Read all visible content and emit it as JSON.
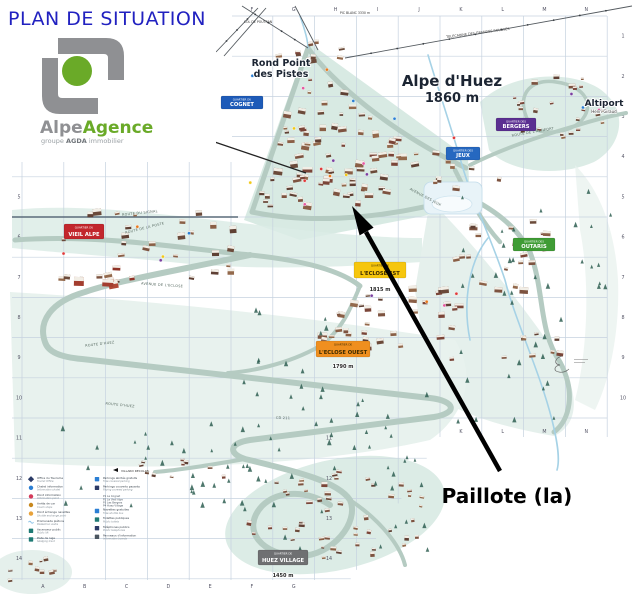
{
  "title": "PLAN DE SITUATION",
  "title_color": "#2121c0",
  "logo": {
    "brand_alpe": "Alpe",
    "brand_agence": "Agence",
    "tagline_prefix": "groupe",
    "tagline_brand": "AGDA",
    "tagline_suffix": "immobilier",
    "gray": "#8f9093",
    "green": "#6aaa28"
  },
  "callout": {
    "label": "Paillote (la)"
  },
  "map": {
    "resort": {
      "name": "Alpe d'Huez",
      "altitude": "1860 m"
    },
    "places": {
      "rond_point_line1": "Rond Point",
      "rond_point_line2": "des Pistes",
      "altiport": "Altiport",
      "altiport_sub": "Henri Giraud",
      "pic_blanc": "PIC BLANC 3330 m",
      "col_de_poutran": "COL DE POUTRAN",
      "telecabine": "TELECABINE DES GRANDES ROUSSES",
      "villard_reculas": "VILLARD RECULAS"
    },
    "quarters": [
      {
        "id": "cognet",
        "prefix": "QUARTIER DU",
        "name": "COGNET",
        "bg": "#1e5bb8",
        "fg": "#ffffff"
      },
      {
        "id": "bergers",
        "prefix": "QUARTIER DES",
        "name": "BERGERS",
        "bg": "#5b2f91",
        "fg": "#ffffff"
      },
      {
        "id": "jeux",
        "prefix": "QUARTIER DES",
        "name": "JEUX",
        "bg": "#2668c0",
        "fg": "#ffffff"
      },
      {
        "id": "vieil_alpe",
        "prefix": "QUARTIER DU",
        "name": "VIEIL ALPE",
        "bg": "#c2262c",
        "fg": "#ffffff"
      },
      {
        "id": "outaris",
        "prefix": "QUARTIER DES",
        "name": "OUTARIS",
        "bg": "#3f9c35",
        "fg": "#ffffff"
      },
      {
        "id": "eclose_est",
        "prefix": "QUARTIER DE",
        "name": "L'ECLOSE EST",
        "bg": "#f6c60e",
        "fg": "#3a2a00"
      },
      {
        "id": "eclose_ouest",
        "prefix": "QUARTIER DE",
        "name": "L'ECLOSE OUEST",
        "bg": "#ef8f1f",
        "fg": "#3a2a00"
      },
      {
        "id": "huez_village",
        "prefix": "QUARTIER DE",
        "name": "HUEZ VILLAGE",
        "bg": "#6f7072",
        "fg": "#ffffff"
      }
    ],
    "altitudes": {
      "eclose_est": "1815 m",
      "eclose_ouest": "1790 m",
      "huez_village": "1450 m"
    },
    "roads": [
      "ROUTE DU SIGNAL",
      "ROUTE DE LA POSTE",
      "ROUTE D'HUEZ",
      "ROUTE D'HUEZ",
      "AVENUE DE L'ECLOSE",
      "AVENUE DES JEUX",
      "ROUTE DE L'ALTIPORT",
      "CD 211"
    ],
    "grid": {
      "columns": [
        "A",
        "B",
        "C",
        "D",
        "E",
        "F",
        "G",
        "H",
        "I",
        "J",
        "K",
        "L",
        "M",
        "N"
      ],
      "rows": [
        "1",
        "2",
        "3",
        "4",
        "5",
        "6",
        "7",
        "8",
        "9",
        "10",
        "11",
        "12",
        "13",
        "14"
      ]
    }
  },
  "legend": {
    "left": [
      {
        "shape": "diamond",
        "color": "#2b3a66",
        "fr": "Office du Tourisme",
        "en": "Tourist Office"
      },
      {
        "shape": "circle",
        "color": "#2b7fd4",
        "fr": "Chalet information",
        "en": "Information chalet"
      },
      {
        "shape": "circle",
        "color": "#d43a5a",
        "fr": "Point information",
        "en": "Information point"
      },
      {
        "shape": "circle",
        "color": "#c8881e",
        "fr": "Arrêts de car",
        "en": "Coach stops"
      },
      {
        "shape": "circle",
        "color": "#e8a23a",
        "fr": "Point échange navettes",
        "en": "Shuttle exchange point"
      },
      {
        "shape": "wave",
        "color": "#8ec4e8",
        "fr": "Promenade piétons",
        "en": "Pedestrian walks"
      },
      {
        "shape": "square",
        "color": "#1e7a74",
        "fr": "Ascenseur public",
        "en": "Public lift"
      },
      {
        "shape": "square",
        "color": "#1e7a74",
        "fr": "Piste de luge",
        "en": "Sledging track"
      }
    ],
    "right": [
      {
        "shape": "square",
        "color": "#2b7fd4",
        "fr": "Parkings abrités gratuits",
        "en": "Free covered parking"
      },
      {
        "shape": "square",
        "color": "#2b3a66",
        "fr": "Parkings couverts payants",
        "en": "Paying covered parking"
      },
      {
        "shape": "list",
        "color": "#4a5560",
        "items": [
          "P1 Le Cognet",
          "P2 Le Vieil Alpe",
          "P3 Les Bergers",
          "P4 Huez Village"
        ]
      },
      {
        "shape": "square",
        "color": "#2b7fd4",
        "fr": "Navettes gratuites",
        "en": "Free shuttle bus"
      },
      {
        "shape": "square",
        "color": "#1e7a74",
        "fr": "Toilettes publiques",
        "en": "Public toilets"
      },
      {
        "shape": "square",
        "color": "#2b3a66",
        "fr": "Téléphones publics",
        "en": "Public telephones"
      },
      {
        "shape": "square",
        "color": "#4a5560",
        "fr": "Panneaux d'information",
        "en": "Information boards"
      }
    ]
  }
}
